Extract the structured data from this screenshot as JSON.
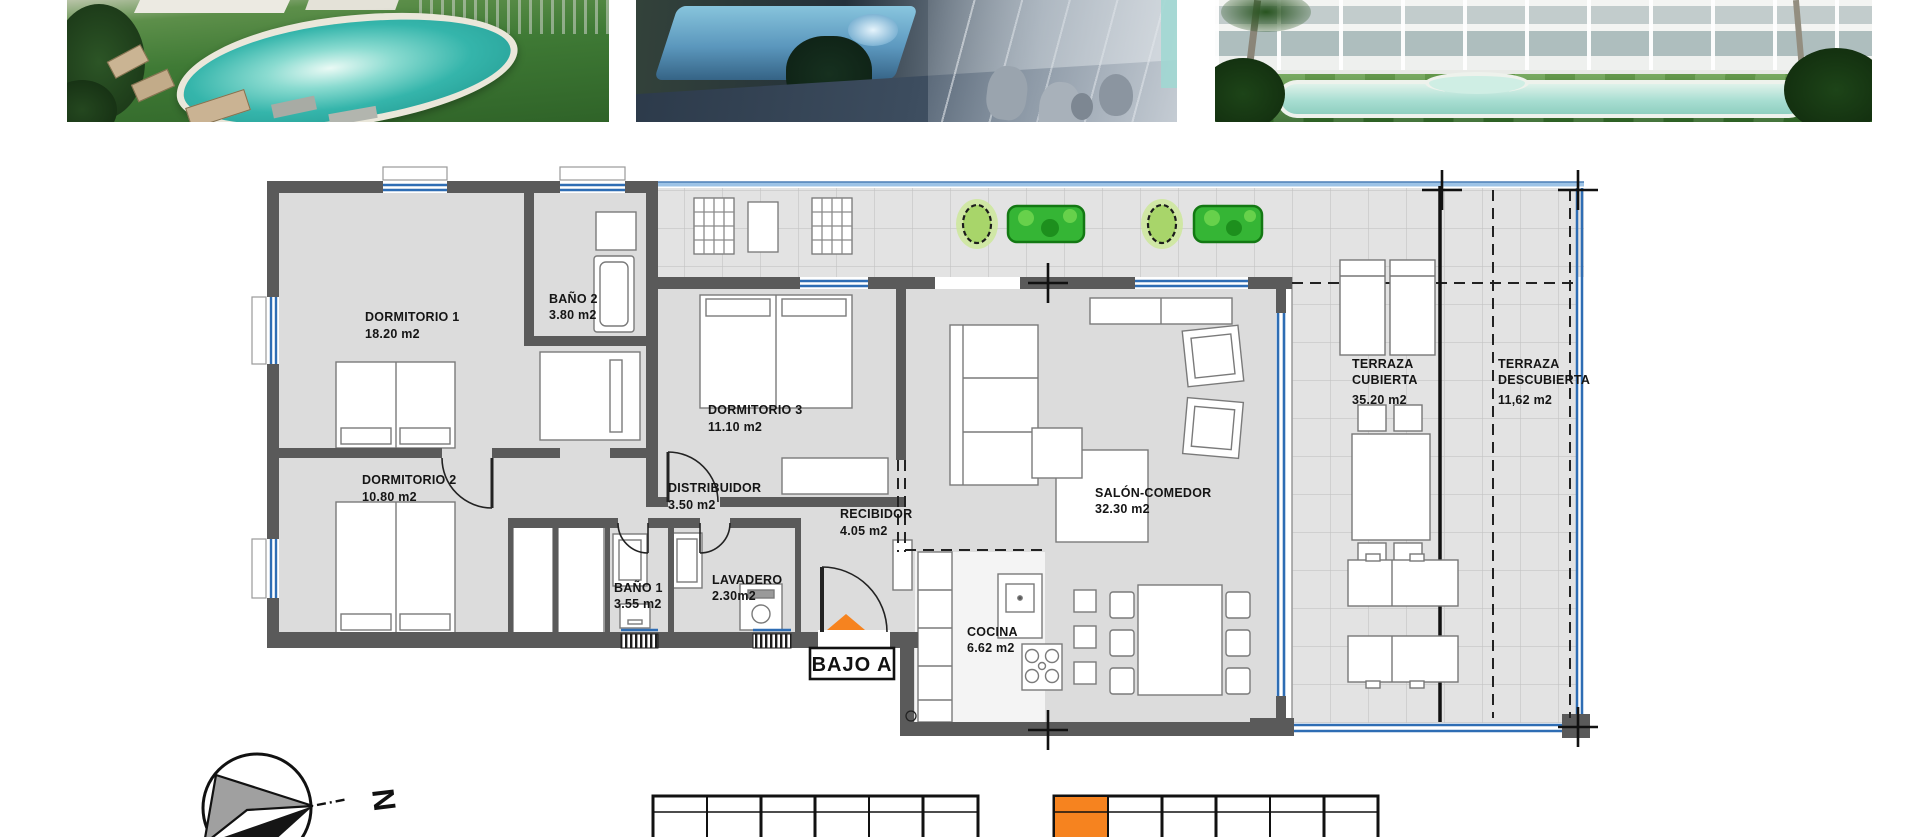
{
  "photos": [
    {
      "label": "garden-pool-day-render"
    },
    {
      "label": "night-terrace-pool-render"
    },
    {
      "label": "building-facade-lawn-pool-render"
    }
  ],
  "floorplan": {
    "unit_label": "BAJO A",
    "rooms": {
      "dormitorio1": {
        "name": "DORMITORIO 1",
        "area": "18.20 m2"
      },
      "bano2": {
        "name": "BAÑO 2",
        "area": "3.80 m2"
      },
      "dormitorio3": {
        "name": "DORMITORIO 3",
        "area": "11.10 m2"
      },
      "dormitorio2": {
        "name": "DORMITORIO 2",
        "area": "10.80 m2"
      },
      "distribuidor": {
        "name": "DISTRIBUIDOR",
        "area": "3.50 m2"
      },
      "recibidor": {
        "name": "RECIBIDOR",
        "area": "4.05 m2"
      },
      "salon_comedor": {
        "name": "SALÓN-COMEDOR",
        "area": "32.30 m2"
      },
      "bano1": {
        "name": "BAÑO 1",
        "area": "3.55 m2"
      },
      "lavadero": {
        "name": "LAVADERO",
        "area": "2.30m2"
      },
      "cocina": {
        "name": "COCINA",
        "area": "6.62 m2"
      },
      "terraza_cubierta": {
        "name_line1": "TERRAZA",
        "name_line2": "CUBIERTA",
        "area": "35.20 m2"
      },
      "terraza_descubierta": {
        "name_line1": "TERRAZA",
        "name_line2": "DESCUBIERTA",
        "area": "11,62 m2"
      }
    },
    "compass": {
      "north_label": "N"
    },
    "colors": {
      "accent_orange": "#F6831F",
      "wall_gray": "#5A5A5A",
      "floor_gray": "#DCDCDC",
      "window_blue": "#2E6DB4",
      "glass_light_blue": "#9DC3E6",
      "plant_green": "#35B535"
    }
  },
  "keyplans": {
    "left_block": {
      "columns": 6,
      "highlighted_column": 0
    },
    "right_block": {
      "columns": 6,
      "highlighted_column": 1
    }
  }
}
